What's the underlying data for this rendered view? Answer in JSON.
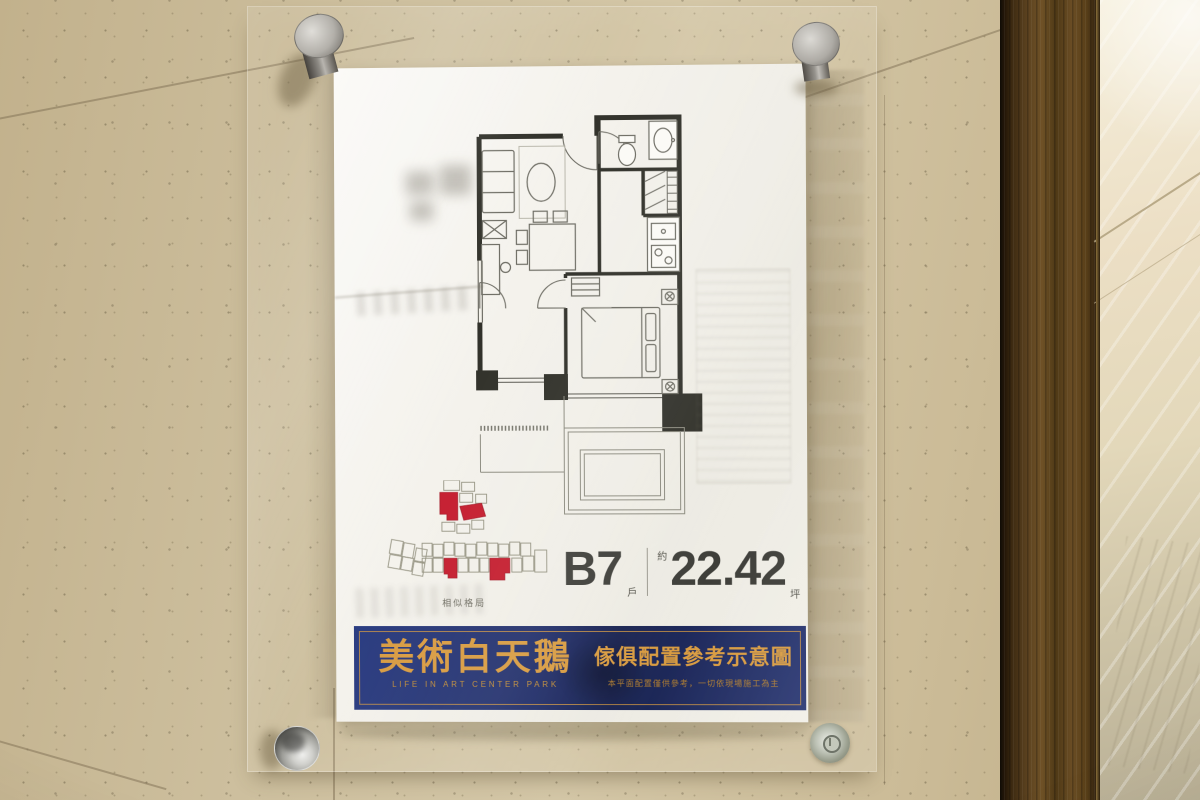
{
  "poster": {
    "unit": {
      "code": "B7",
      "suffix": "戶",
      "approx": "約",
      "area": "22.42",
      "area_unit": "坪"
    },
    "site_key": {
      "caption": "相似格局",
      "highlight_color": "#c41a2c"
    },
    "banner": {
      "brand": "美術白天鵝",
      "brand_en": "LIFE IN ART CENTER PARK",
      "title": "傢俱配置參考示意圖",
      "disclaimer": "本平面配置僅供參考，一切依現場施工為主",
      "navy": "#1d2a66",
      "gold": "#d89a3e"
    }
  },
  "hardware": {
    "standoff_pin_count": "4"
  },
  "colors": {
    "wall_beige": "#cbbd9c",
    "plan_ink": "#2d2d26"
  }
}
